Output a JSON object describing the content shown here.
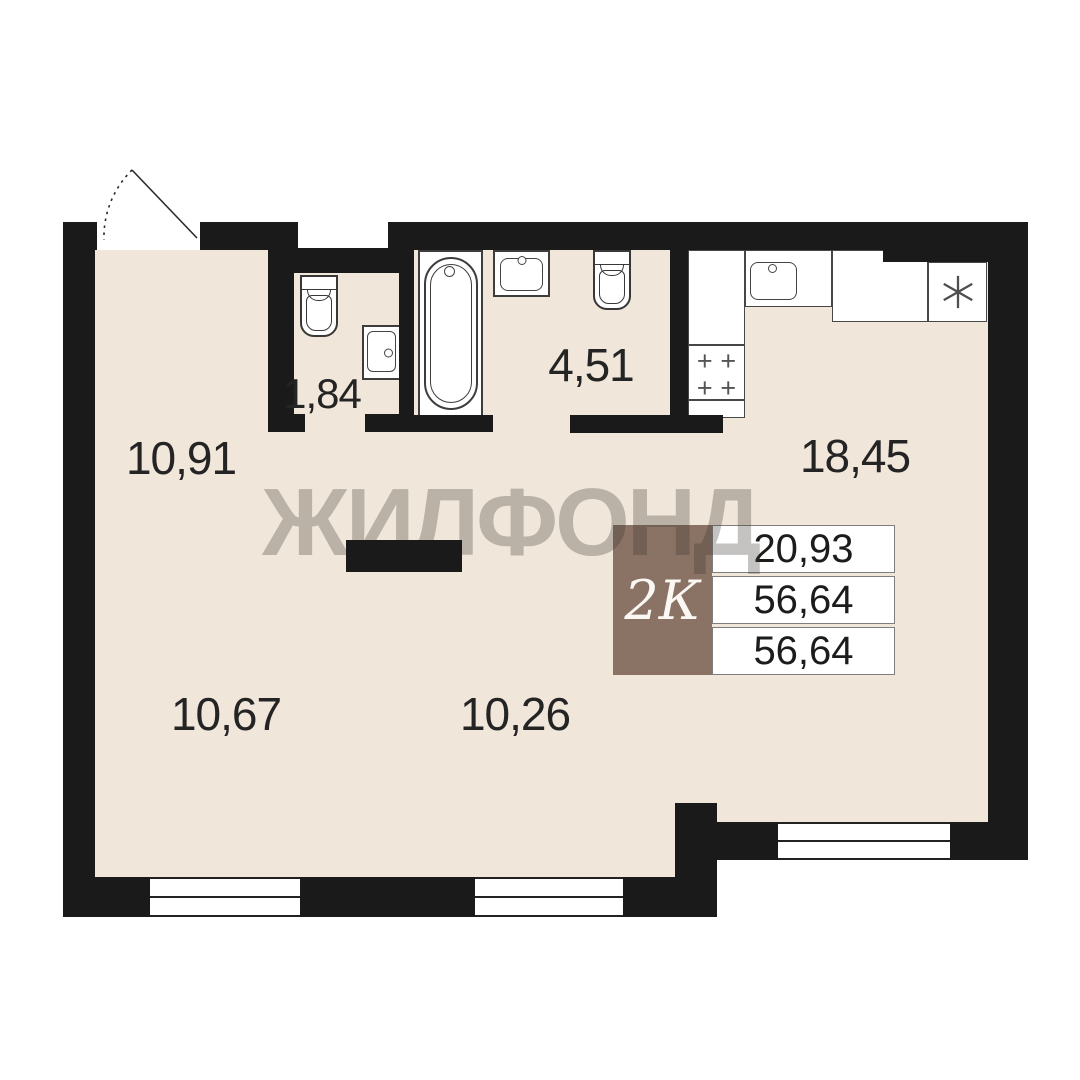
{
  "plan": {
    "watermark_text": "ЖИЛФОНД",
    "rooms": {
      "hallway": {
        "area": "10,91"
      },
      "wc": {
        "area": "1,84"
      },
      "bathroom": {
        "area": "4,51"
      },
      "kitchen_living": {
        "area": "18,45"
      },
      "room_bottom_left": {
        "area": "10,67"
      },
      "room_bottom_middle": {
        "area": "10,26"
      }
    },
    "info_box": {
      "type_label": "2К",
      "rows": [
        "20,93",
        "56,64",
        "56,64"
      ]
    },
    "stove": {
      "burner_symbol": "+"
    },
    "icons": {
      "fridge": "six-spoke-asterisk",
      "door": "door-swing-arc",
      "fixtures": [
        "toilet-icon",
        "sink-icon",
        "bathtub-icon",
        "kitchen-sink-icon",
        "stove-icon"
      ]
    },
    "colors": {
      "wall": "#1a1a1a",
      "floor": "#f1e6da",
      "info_badge": "#8a7265",
      "watermark": "rgba(60,55,50,0.30)"
    }
  }
}
